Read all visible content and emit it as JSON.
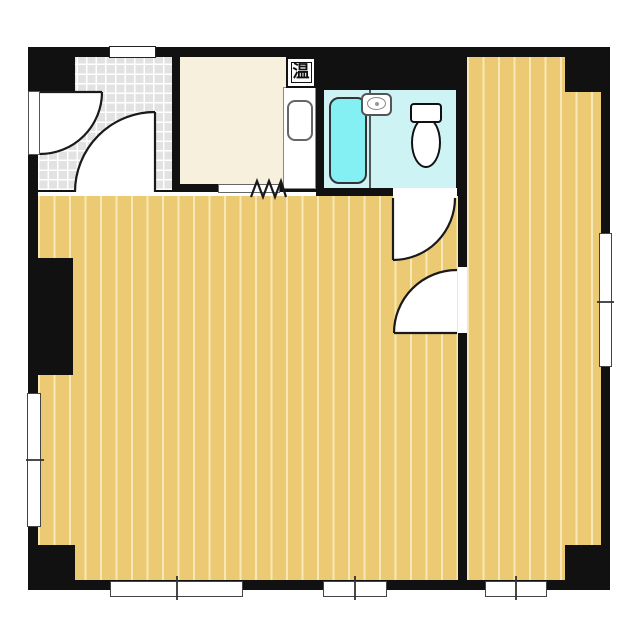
{
  "floorplan": {
    "water_heater_label": "温",
    "colors": {
      "wall": "#111111",
      "floor": "#ecca74",
      "floor_stripe": "#f7e8b5",
      "tile": "#e2e2e2",
      "tile_line": "#ffffff",
      "kitchen": "#f6f0dc",
      "bathroom": "#cdf3f5",
      "bathtub": "#84f0f4"
    }
  }
}
